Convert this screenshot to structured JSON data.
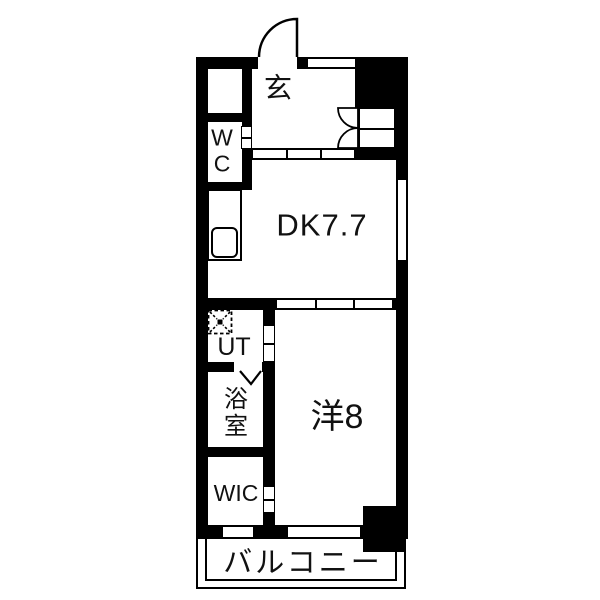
{
  "plan_type": "apartment-floor-plan",
  "rooms": {
    "genkan": {
      "label": "玄"
    },
    "wc": {
      "label": "WC"
    },
    "dk": {
      "label": "DK7.7"
    },
    "ut": {
      "label": "UT"
    },
    "bath": {
      "label": "浴室"
    },
    "western": {
      "label": "洋8"
    },
    "wic": {
      "label": "WIC"
    },
    "balcony": {
      "label": "バルコニー"
    }
  },
  "colors": {
    "wall": "#000000",
    "floor": "#ffffff",
    "text": "#111111"
  }
}
